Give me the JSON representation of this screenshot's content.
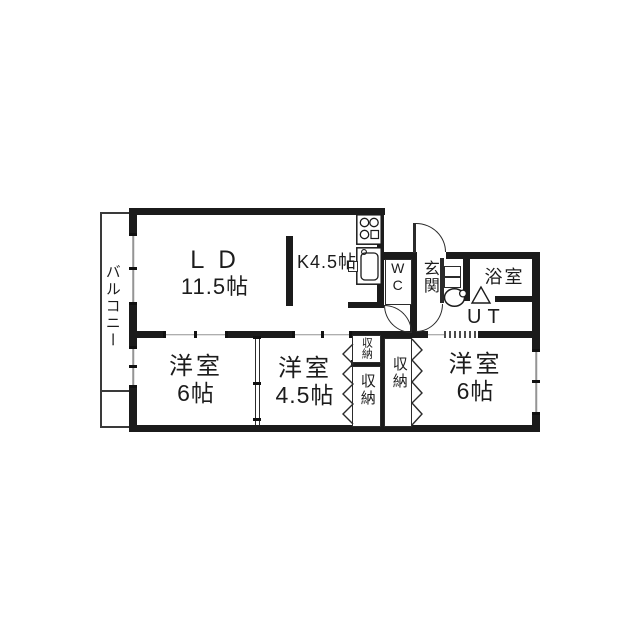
{
  "plan_title": "3LDK apartment floor plan",
  "rooms": {
    "balcony": {
      "label": "バルコニー"
    },
    "living_dining": {
      "label": "ＬＤ",
      "size": "11.5帖"
    },
    "kitchen": {
      "label": "K4.5帖"
    },
    "wc": {
      "label": "WC"
    },
    "entrance": {
      "label": "玄関"
    },
    "bathroom": {
      "label": "浴室"
    },
    "utility": {
      "label": "UT"
    },
    "bedroom_left": {
      "label": "洋室",
      "size": "6帖"
    },
    "bedroom_center": {
      "label": "洋室",
      "size": "4.5帖"
    },
    "bedroom_right": {
      "label": "洋室",
      "size": "6帖"
    },
    "closet_small": {
      "label": "収納"
    },
    "closet_left": {
      "label": "収納"
    },
    "closet_right": {
      "label": "収納"
    }
  },
  "icons": {
    "stove": "stove-icon",
    "sink": "sink-icon",
    "washbasin": "washbasin-icon",
    "shoe_cabinet": "shoe-cabinet-icon",
    "bath_door": "bath-door-triangle-icon",
    "bifold_doors": "bifold-door-icon",
    "swing_doors": "door-arc-icon"
  },
  "colors": {
    "wall": "#1b1b1b",
    "thin_line": "#2b2b2b",
    "window_line": "#949494",
    "background": "#ffffff"
  }
}
